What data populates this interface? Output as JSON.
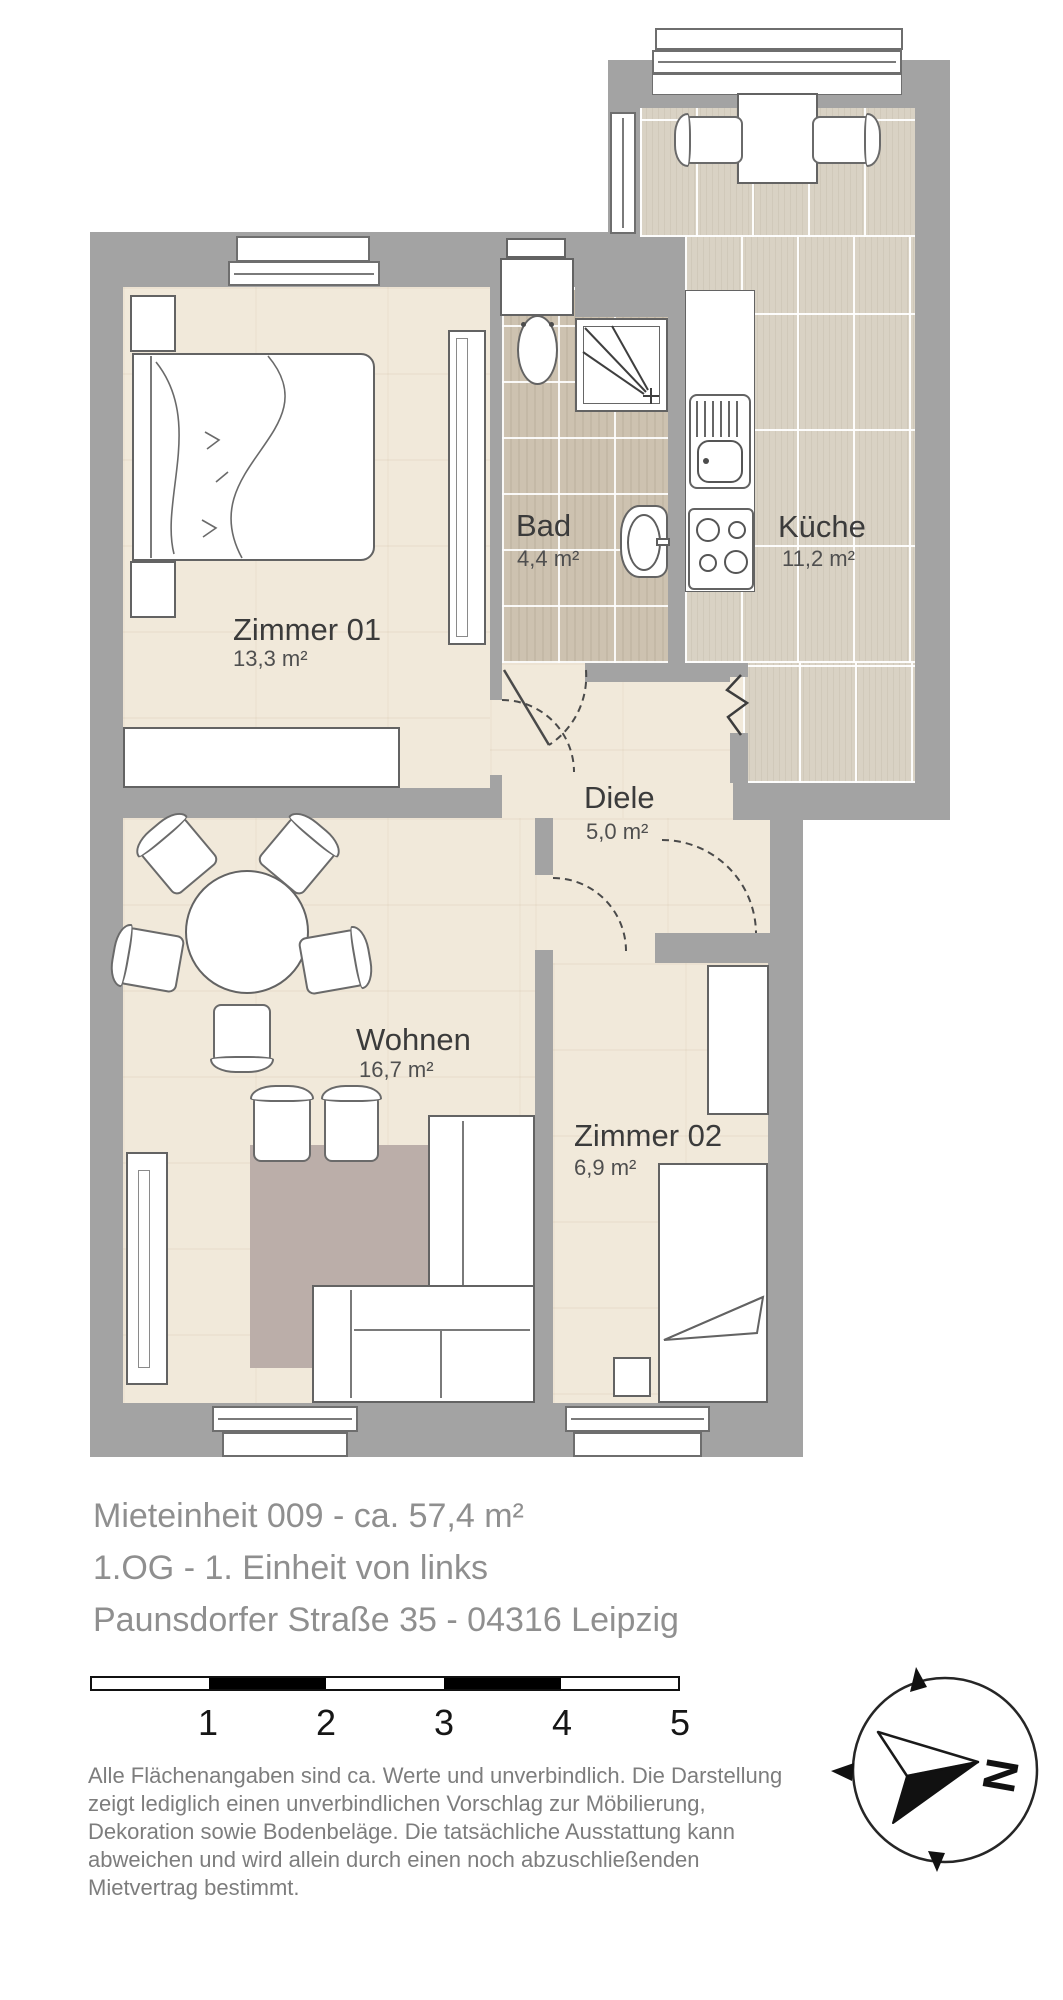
{
  "colors": {
    "wall": "#a3a3a3",
    "wood_floor": "#f1e9da",
    "bad_tile": "#cdc2b0",
    "kitchen_tile": "#d9d2c4",
    "rug": "#bbaea9"
  },
  "floorplan": {
    "rooms": [
      {
        "name": "Zimmer 01",
        "area": "13,3 m²"
      },
      {
        "name": "Bad",
        "area": "4,4 m²"
      },
      {
        "name": "Küche",
        "area": "11,2 m²"
      },
      {
        "name": "Diele",
        "area": "5,0 m²"
      },
      {
        "name": "Wohnen",
        "area": "16,7 m²"
      },
      {
        "name": "Zimmer 02",
        "area": "6,9 m²"
      }
    ],
    "compass": {
      "north_label": "N"
    },
    "scale_bar": {
      "tick_labels": [
        "1",
        "2",
        "3",
        "4",
        "5"
      ]
    }
  },
  "title_block": {
    "unit_line": "Mieteinheit 009 - ca. 57,4 m²",
    "floor_line": "1.OG - 1. Einheit von links",
    "address_line": "Paunsdorfer Straße 35 - 04316 Leipzig"
  },
  "disclaimer": {
    "lines": [
      "Alle Flächenangaben sind ca. Werte und unverbindlich. Die Darstellung",
      "zeigt lediglich einen unverbindlichen Vorschlag zur Möbilierung,",
      "Dekoration sowie Bodenbeläge. Die tatsächliche  Ausstattung kann",
      "abweichen und wird allein durch einen noch abzuschließenden",
      "Mietvertrag bestimmt."
    ]
  }
}
